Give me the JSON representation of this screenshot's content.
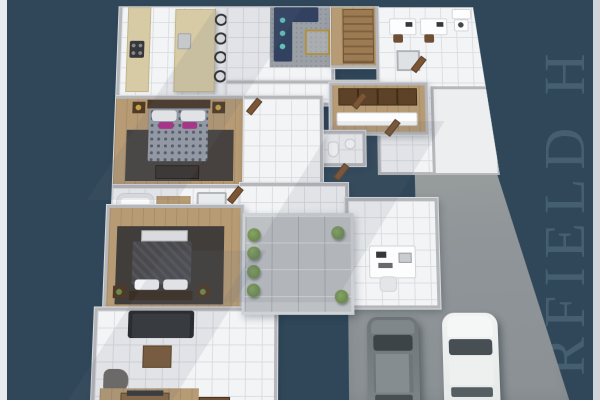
{
  "scene": {
    "description": "3D rendered top-down floor plan of a single-storey house with courtyard, garage driveway and two parked cars, on a dark slate-blue backdrop",
    "background_color": "#2f4759",
    "left_edge_strip_color": "#e9ecef",
    "right_edge_strip_color": "#dfe4e8"
  },
  "watermark": {
    "visible_text": "RFIELD H",
    "reading_direction": "bottom-to-top",
    "color": "#4a6476",
    "font_style": "serif"
  },
  "palette": {
    "floor_tile": "#f3f4f6",
    "wood_floor": "#b79b74",
    "walls": "#b5b7bb",
    "kitchen_counter_beige": "#d7cba5",
    "sofa_navy": "#32415f",
    "pillow_teal": "#5fc4bc",
    "sofa_charcoal": "#33363a",
    "rug_gray": "#9aa0a6",
    "rug_dark": "#413d3b",
    "bed_duvet_pattern_gray": "#99a0aa",
    "accent_pillow_magenta": "#b0308a",
    "furniture_brown": "#7b5b3b",
    "closet_brown": "#5d4227",
    "gold_accent": "#b3903f",
    "courtyard_paver_gray": "#bdc1c4",
    "driveway_gray": "#8f9598",
    "plant_green": "#6b8a4c",
    "suv_gray": "#7b8184",
    "sedan_white": "#eceff0"
  },
  "inventory": {
    "rooms": [
      "kitchen",
      "family-room",
      "entry-stairs",
      "study",
      "laundry",
      "walk-in-wardrobe",
      "powder-room",
      "bedroom-2",
      "bathroom",
      "master-bedroom",
      "living-room",
      "media-area",
      "home-office",
      "courtyard",
      "garage-driveway"
    ],
    "kitchen_bar_stools": 4,
    "wardrobe_closet_panels": 4,
    "courtyard_plants": 6,
    "beds": 2,
    "sofas": 2,
    "desks": 3,
    "vehicles": [
      {
        "type": "suv",
        "color": "gray"
      },
      {
        "type": "sedan",
        "color": "white"
      }
    ]
  }
}
